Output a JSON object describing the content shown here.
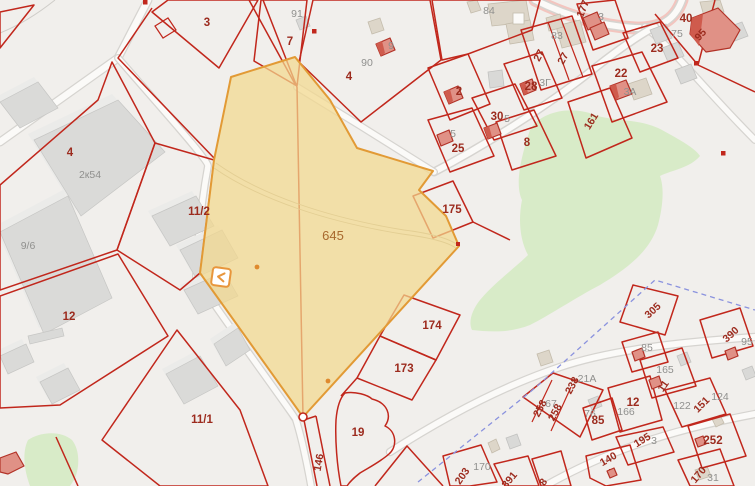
{
  "map": {
    "type": "cadastral-map",
    "highlighted_parcel": {
      "number": "645",
      "fill": "#f2d88e",
      "border": "#e29a35"
    }
  },
  "colors": {
    "background": "#f1efec",
    "parcel_line": "#c1271c",
    "label_red": "#9c2b1e",
    "label_gray": "#90908e",
    "label_highlight": "#a8692e",
    "vegetation": "#d8ebc8",
    "building_gray": "#dadad8",
    "building_red": "#e09186",
    "boundary_dashed": "#8a92de",
    "road_pink": "#f3c5bf"
  },
  "icons": [
    {
      "name": "collapse-chevron-icon",
      "glyph": "‹",
      "x": 221,
      "y": 277
    }
  ],
  "labels": [
    {
      "text": "3",
      "x": 207,
      "y": 26,
      "rot": 0,
      "cls": "red"
    },
    {
      "text": "91",
      "x": 297,
      "y": 17,
      "rot": 0,
      "cls": "gray"
    },
    {
      "text": "7",
      "x": 290,
      "y": 45,
      "rot": 0,
      "cls": "red"
    },
    {
      "text": "9",
      "x": 391,
      "y": 49,
      "rot": 0,
      "cls": "gray"
    },
    {
      "text": "90",
      "x": 367,
      "y": 66,
      "rot": 0,
      "cls": "gray"
    },
    {
      "text": "4",
      "x": 349,
      "y": 80,
      "rot": 0,
      "cls": "red"
    },
    {
      "text": "84",
      "x": 489,
      "y": 14,
      "rot": 0,
      "cls": "gray"
    },
    {
      "text": "83",
      "x": 557,
      "y": 39,
      "rot": 0,
      "cls": "gray"
    },
    {
      "text": "27",
      "x": 542,
      "y": 57,
      "rot": -62,
      "cls": "redr"
    },
    {
      "text": "27",
      "x": 566,
      "y": 60,
      "rot": -62,
      "cls": "redr"
    },
    {
      "text": "177",
      "x": 586,
      "y": 10,
      "rot": -68,
      "cls": "redr"
    },
    {
      "text": "3",
      "x": 601,
      "y": 20,
      "rot": 0,
      "cls": "gray"
    },
    {
      "text": "40",
      "x": 686,
      "y": 22,
      "rot": 0,
      "cls": "red"
    },
    {
      "text": "95",
      "x": 703,
      "y": 37,
      "rot": -48,
      "cls": "redr"
    },
    {
      "text": "75",
      "x": 677,
      "y": 37,
      "rot": 0,
      "cls": "gray"
    },
    {
      "text": "23",
      "x": 657,
      "y": 52,
      "rot": 0,
      "cls": "red"
    },
    {
      "text": "22",
      "x": 621,
      "y": 77,
      "rot": 0,
      "cls": "red"
    },
    {
      "text": "3А",
      "x": 630,
      "y": 95,
      "rot": 0,
      "cls": "gray"
    },
    {
      "text": "2",
      "x": 459,
      "y": 95,
      "rot": 0,
      "cls": "red"
    },
    {
      "text": "28",
      "x": 531,
      "y": 90,
      "rot": 0,
      "cls": "red"
    },
    {
      "text": "3Г",
      "x": 545,
      "y": 86,
      "rot": 0,
      "cls": "gray"
    },
    {
      "text": "30",
      "x": 497,
      "y": 120,
      "rot": 0,
      "cls": "red"
    },
    {
      "text": "5",
      "x": 507,
      "y": 122,
      "rot": 0,
      "cls": "gray"
    },
    {
      "text": "5",
      "x": 453,
      "y": 137,
      "rot": 0,
      "cls": "gray"
    },
    {
      "text": "25",
      "x": 458,
      "y": 152,
      "rot": 0,
      "cls": "red"
    },
    {
      "text": "8",
      "x": 527,
      "y": 146,
      "rot": 0,
      "cls": "red"
    },
    {
      "text": "161",
      "x": 594,
      "y": 123,
      "rot": -58,
      "cls": "redr"
    },
    {
      "text": "645",
      "x": 333,
      "y": 240,
      "rot": 0,
      "cls": "ochre"
    },
    {
      "text": "175",
      "x": 452,
      "y": 213,
      "rot": 0,
      "cls": "red"
    },
    {
      "text": "4",
      "x": 70,
      "y": 156,
      "rot": 0,
      "cls": "red"
    },
    {
      "text": "2к54",
      "x": 90,
      "y": 178,
      "rot": 0,
      "cls": "gray"
    },
    {
      "text": "11/2",
      "x": 199,
      "y": 215,
      "rot": 0,
      "cls": "red"
    },
    {
      "text": "9/6",
      "x": 28,
      "y": 249,
      "rot": 0,
      "cls": "gray"
    },
    {
      "text": "12",
      "x": 69,
      "y": 320,
      "rot": 0,
      "cls": "red"
    },
    {
      "text": "11/1",
      "x": 202,
      "y": 423,
      "rot": 0,
      "cls": "red"
    },
    {
      "text": "174",
      "x": 432,
      "y": 329,
      "rot": 0,
      "cls": "red"
    },
    {
      "text": "173",
      "x": 404,
      "y": 372,
      "rot": 0,
      "cls": "red"
    },
    {
      "text": "19",
      "x": 358,
      "y": 436,
      "rot": 0,
      "cls": "red"
    },
    {
      "text": "146",
      "x": 322,
      "y": 463,
      "rot": -80,
      "cls": "redr"
    },
    {
      "text": "203",
      "x": 465,
      "y": 478,
      "rot": -55,
      "cls": "redr"
    },
    {
      "text": "170",
      "x": 482,
      "y": 470,
      "rot": 0,
      "cls": "gray"
    },
    {
      "text": "391",
      "x": 512,
      "y": 482,
      "rot": -50,
      "cls": "redr"
    },
    {
      "text": "8",
      "x": 546,
      "y": 484,
      "rot": -55,
      "cls": "redr"
    },
    {
      "text": "305",
      "x": 655,
      "y": 313,
      "rot": -42,
      "cls": "redr"
    },
    {
      "text": "390",
      "x": 733,
      "y": 337,
      "rot": -42,
      "cls": "redr"
    },
    {
      "text": "95",
      "x": 747,
      "y": 345,
      "rot": 0,
      "cls": "gray"
    },
    {
      "text": "85",
      "x": 647,
      "y": 351,
      "rot": 0,
      "cls": "gray"
    },
    {
      "text": "165",
      "x": 665,
      "y": 373,
      "rot": 0,
      "cls": "gray"
    },
    {
      "text": "11",
      "x": 666,
      "y": 388,
      "rot": -55,
      "cls": "redr"
    },
    {
      "text": "238",
      "x": 575,
      "y": 387,
      "rot": -62,
      "cls": "redr"
    },
    {
      "text": "21А",
      "x": 587,
      "y": 382,
      "rot": 0,
      "cls": "gray"
    },
    {
      "text": "258",
      "x": 543,
      "y": 410,
      "rot": -62,
      "cls": "redr"
    },
    {
      "text": "67",
      "x": 551,
      "y": 407,
      "rot": 0,
      "cls": "gray"
    },
    {
      "text": "258",
      "x": 558,
      "y": 414,
      "rot": -62,
      "cls": "redr"
    },
    {
      "text": "12",
      "x": 633,
      "y": 406,
      "rot": 0,
      "cls": "red"
    },
    {
      "text": "166",
      "x": 626,
      "y": 415,
      "rot": 0,
      "cls": "gray"
    },
    {
      "text": "76",
      "x": 590,
      "y": 417,
      "rot": 0,
      "cls": "gray"
    },
    {
      "text": "85",
      "x": 598,
      "y": 424,
      "rot": 0,
      "cls": "red"
    },
    {
      "text": "122",
      "x": 682,
      "y": 409,
      "rot": 0,
      "cls": "gray"
    },
    {
      "text": "151",
      "x": 704,
      "y": 407,
      "rot": -45,
      "cls": "redr"
    },
    {
      "text": "124",
      "x": 720,
      "y": 400,
      "rot": 0,
      "cls": "gray"
    },
    {
      "text": "195",
      "x": 644,
      "y": 443,
      "rot": -32,
      "cls": "redr"
    },
    {
      "text": "3",
      "x": 654,
      "y": 444,
      "rot": 0,
      "cls": "gray"
    },
    {
      "text": "140",
      "x": 610,
      "y": 462,
      "rot": -30,
      "cls": "redr"
    },
    {
      "text": "252",
      "x": 713,
      "y": 444,
      "rot": 0,
      "cls": "red"
    },
    {
      "text": "170",
      "x": 701,
      "y": 477,
      "rot": -50,
      "cls": "redr"
    },
    {
      "text": "31",
      "x": 713,
      "y": 481,
      "rot": 0,
      "cls": "gray"
    }
  ]
}
